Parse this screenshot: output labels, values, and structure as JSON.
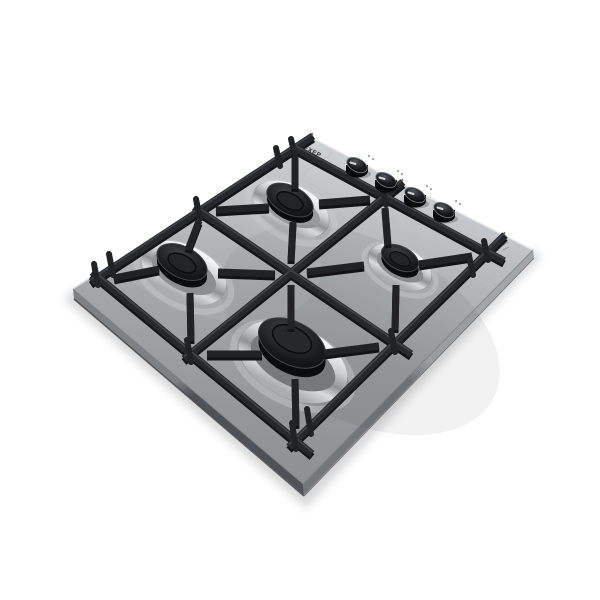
{
  "scene": {
    "background": "#ffffff",
    "subject": "Built-in 4-burner gas hob, stainless steel, angled product photo on white background",
    "brand_mark": "EXEP"
  },
  "hob": {
    "finish": "stainless steel",
    "grate": {
      "material": "cast iron",
      "color_hex": "#26282c",
      "layout": "3x3 bar grid with inward prongs over each burner and upright corner prongs"
    },
    "burners": [
      {
        "name": "front-left",
        "screen_position": "top",
        "size": "semi-rapid",
        "cap": "black",
        "ring": "chrome"
      },
      {
        "name": "front-right",
        "screen_position": "right",
        "size": "auxiliary",
        "cap": "black",
        "ring": "chrome"
      },
      {
        "name": "back-left",
        "screen_position": "left",
        "size": "semi-rapid",
        "cap": "black",
        "ring": "chrome"
      },
      {
        "name": "back-right",
        "screen_position": "bottom",
        "size": "rapid",
        "cap": "black",
        "ring": "chrome"
      }
    ],
    "knobs": {
      "count": 4,
      "finish": "glossy black",
      "indicator": "light tick mark"
    },
    "markings": {
      "control_panel_seam": "faint etched rectangle around the knob row",
      "corner_etching": "small etched symbol near the right corner"
    }
  },
  "colors": {
    "steel_light": "#c8cbcd",
    "steel_mid": "#a2a6a9",
    "steel_dark": "#8c9093",
    "grate_black": "#26282c",
    "burner_cap": "#141517",
    "chrome_highlight": "#f2f4f5",
    "chrome_shadow": "#8f9396",
    "knob_black": "#0b0c0e",
    "knob_indicator": "#d4d7da",
    "side_left": "#60646a",
    "side_right": "#94989b"
  }
}
